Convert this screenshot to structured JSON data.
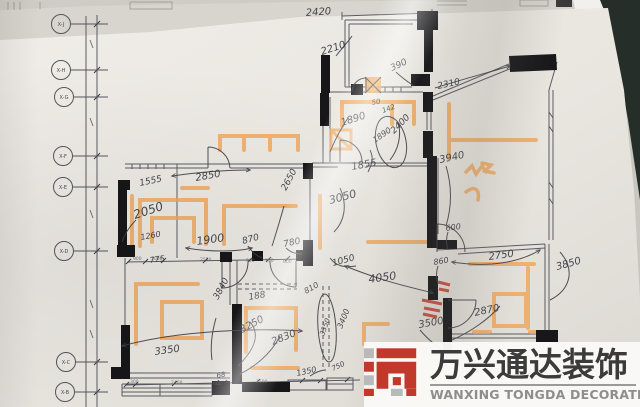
{
  "watermark": {
    "cn": "万兴通达装饰",
    "en": "WANXING TONGDA DECORATION",
    "brand_red": "#c0392b",
    "brand_gray": "#b9b9b9",
    "text_dark": "#3b3b3b"
  },
  "colors": {
    "pencil_ink": "#34343c",
    "print_line": "#5b5b63",
    "wall_black": "#17171a",
    "orange_marker": "#f0a455",
    "red_marker": "#c23a2b",
    "paper": "#eae7e1",
    "table_dark": "#252e28"
  },
  "grid_labels": [
    {
      "label": "X-J",
      "x": 61,
      "y": 24
    },
    {
      "label": "X-H",
      "x": 61,
      "y": 70
    },
    {
      "label": "X-G",
      "x": 64,
      "y": 97
    },
    {
      "label": "X-F",
      "x": 63,
      "y": 156
    },
    {
      "label": "X-E",
      "x": 63,
      "y": 187
    },
    {
      "label": "X-D",
      "x": 64,
      "y": 251
    },
    {
      "label": "X-C",
      "x": 66,
      "y": 362
    },
    {
      "label": "X-B",
      "x": 65,
      "y": 392
    }
  ],
  "annotations": {
    "hand": [
      {
        "t": "2420",
        "x": 306,
        "y": 16,
        "r": -4,
        "s": 10
      },
      {
        "t": "2210",
        "x": 322,
        "y": 55,
        "r": -18,
        "s": 10
      },
      {
        "t": "390",
        "x": 392,
        "y": 71,
        "r": -25,
        "s": 9
      },
      {
        "t": "2310",
        "x": 438,
        "y": 89,
        "r": -12,
        "s": 9
      },
      {
        "t": "50",
        "x": 372,
        "y": 105,
        "r": -10,
        "s": 7
      },
      {
        "t": "142",
        "x": 383,
        "y": 113,
        "r": -20,
        "s": 7
      },
      {
        "t": "1890",
        "x": 342,
        "y": 126,
        "r": -18,
        "s": 10
      },
      {
        "t": "1890",
        "x": 375,
        "y": 143,
        "r": -35,
        "s": 8
      },
      {
        "t": "2400",
        "x": 394,
        "y": 134,
        "r": -45,
        "s": 9
      },
      {
        "t": "1855",
        "x": 352,
        "y": 170,
        "r": -10,
        "s": 10
      },
      {
        "t": "3940",
        "x": 440,
        "y": 163,
        "r": -12,
        "s": 10
      },
      {
        "t": "3050",
        "x": 330,
        "y": 204,
        "r": -15,
        "s": 11
      },
      {
        "t": "1555",
        "x": 140,
        "y": 186,
        "r": -12,
        "s": 9
      },
      {
        "t": "2850",
        "x": 196,
        "y": 181,
        "r": -10,
        "s": 10
      },
      {
        "t": "2050",
        "x": 135,
        "y": 219,
        "r": -18,
        "s": 12
      },
      {
        "t": "1260",
        "x": 141,
        "y": 240,
        "r": -10,
        "s": 8
      },
      {
        "t": "775",
        "x": 150,
        "y": 263,
        "r": -8,
        "s": 8
      },
      {
        "t": "1900",
        "x": 197,
        "y": 245,
        "r": -8,
        "s": 11
      },
      {
        "t": "870",
        "x": 243,
        "y": 244,
        "r": -15,
        "s": 9
      },
      {
        "t": "780",
        "x": 284,
        "y": 247,
        "r": -12,
        "s": 9
      },
      {
        "t": "2650",
        "x": 286,
        "y": 191,
        "r": -62,
        "s": 9
      },
      {
        "t": "860",
        "x": 434,
        "y": 265,
        "r": -10,
        "s": 8
      },
      {
        "t": "600",
        "x": 446,
        "y": 231,
        "r": -8,
        "s": 8
      },
      {
        "t": "2750",
        "x": 489,
        "y": 260,
        "r": -8,
        "s": 10
      },
      {
        "t": "3850",
        "x": 557,
        "y": 270,
        "r": -15,
        "s": 10
      },
      {
        "t": "2870",
        "x": 475,
        "y": 316,
        "r": -12,
        "s": 10
      },
      {
        "t": "3500",
        "x": 419,
        "y": 328,
        "r": -10,
        "s": 10
      },
      {
        "t": "1050",
        "x": 333,
        "y": 266,
        "r": -15,
        "s": 9
      },
      {
        "t": "4050",
        "x": 369,
        "y": 283,
        "r": -8,
        "s": 11
      },
      {
        "t": "810",
        "x": 306,
        "y": 294,
        "r": -30,
        "s": 8
      },
      {
        "t": "188",
        "x": 249,
        "y": 300,
        "r": -10,
        "s": 9
      },
      {
        "t": "3840",
        "x": 218,
        "y": 300,
        "r": -62,
        "s": 9
      },
      {
        "t": "3250",
        "x": 242,
        "y": 333,
        "r": -28,
        "s": 10
      },
      {
        "t": "2830",
        "x": 273,
        "y": 345,
        "r": -22,
        "s": 10
      },
      {
        "t": "3350",
        "x": 155,
        "y": 355,
        "r": -8,
        "s": 10
      },
      {
        "t": "68",
        "x": 217,
        "y": 378,
        "r": -10,
        "s": 7
      },
      {
        "t": "1350",
        "x": 297,
        "y": 376,
        "r": -12,
        "s": 8
      },
      {
        "t": "750",
        "x": 333,
        "y": 371,
        "r": -25,
        "s": 7
      },
      {
        "t": "3400",
        "x": 342,
        "y": 329,
        "r": -68,
        "s": 8
      },
      {
        "t": "3350",
        "x": 324,
        "y": 336,
        "r": -70,
        "s": 7
      }
    ],
    "print": [
      {
        "t": "900",
        "x": 133,
        "y": 260,
        "s": 4.5
      },
      {
        "t": "1000",
        "x": 151,
        "y": 260,
        "s": 4.5
      },
      {
        "t": "2550",
        "x": 200,
        "y": 261,
        "s": 4.5
      },
      {
        "t": "900",
        "x": 246,
        "y": 262,
        "s": 4.5
      },
      {
        "t": "750",
        "x": 265,
        "y": 262,
        "s": 4.5
      },
      {
        "t": "800",
        "x": 283,
        "y": 263,
        "s": 4.5
      },
      {
        "t": "300",
        "x": 130,
        "y": 383,
        "s": 4.5
      },
      {
        "t": "2400",
        "x": 171,
        "y": 384,
        "s": 4.5
      },
      {
        "t": "600",
        "x": 213,
        "y": 385,
        "s": 4.5
      },
      {
        "t": "1500",
        "x": 256,
        "y": 383,
        "s": 4.5
      }
    ]
  }
}
